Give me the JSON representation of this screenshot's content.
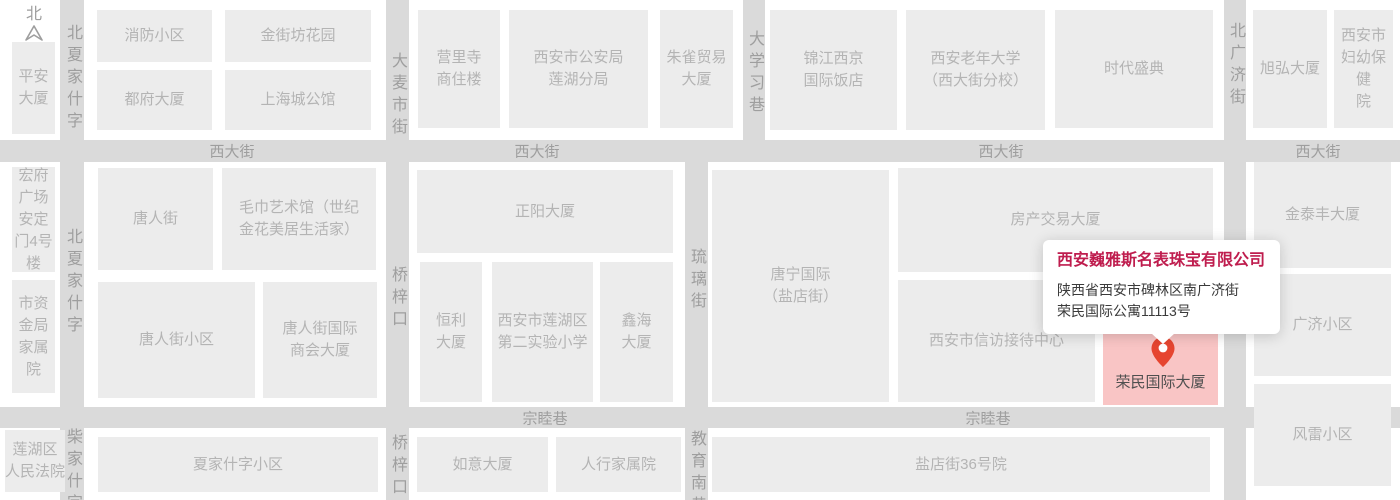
{
  "map": {
    "colors": {
      "street": "#dadada",
      "block": "#ececec",
      "block_text": "#b4b4b4",
      "street_text": "#9e9e9e",
      "highlight_bg": "#f9c5c5",
      "highlight_text": "#4f4f4f",
      "popup_title": "#bf1d4e",
      "popup_text": "#3a3a3a",
      "pin": "#e64530"
    },
    "compass": {
      "label": "北",
      "x": 22,
      "y": 6
    },
    "streets": [
      {
        "o": "h",
        "x": 0,
        "y": 140,
        "w": 1400,
        "h": 22
      },
      {
        "o": "h",
        "x": 0,
        "y": 407,
        "w": 1400,
        "h": 21
      },
      {
        "o": "v",
        "x": 60,
        "y": 0,
        "w": 24,
        "h": 500
      },
      {
        "o": "v",
        "x": 386,
        "y": 0,
        "w": 23,
        "h": 500
      },
      {
        "o": "v",
        "x": 743,
        "y": 0,
        "w": 22,
        "h": 162
      },
      {
        "o": "v",
        "x": 685,
        "y": 140,
        "w": 23,
        "h": 360
      },
      {
        "o": "v",
        "x": 1224,
        "y": 0,
        "w": 22,
        "h": 500
      }
    ],
    "street_labels": [
      {
        "text": "西大街",
        "x": 232,
        "y": 151,
        "v": false
      },
      {
        "text": "西大街",
        "x": 537,
        "y": 151,
        "v": false
      },
      {
        "text": "西大街",
        "x": 1001,
        "y": 151,
        "v": false
      },
      {
        "text": "西大街",
        "x": 1318,
        "y": 151,
        "v": false
      },
      {
        "text": "宗睦巷",
        "x": 545,
        "y": 418,
        "v": false
      },
      {
        "text": "宗睦巷",
        "x": 988,
        "y": 418,
        "v": false
      },
      {
        "text": "北夏家什字",
        "x": 72,
        "y": 24,
        "v": true
      },
      {
        "text": "北夏家什字",
        "x": 72,
        "y": 228,
        "v": true
      },
      {
        "text": "柴家什字",
        "x": 72,
        "y": 428,
        "v": true
      },
      {
        "text": "大麦市街",
        "x": 397,
        "y": 52,
        "v": true
      },
      {
        "text": "桥梓口",
        "x": 397,
        "y": 266,
        "v": true
      },
      {
        "text": "桥梓口",
        "x": 397,
        "y": 434,
        "v": true
      },
      {
        "text": "大学习巷",
        "x": 754,
        "y": 30,
        "v": true
      },
      {
        "text": "琉璃街",
        "x": 696,
        "y": 248,
        "v": true
      },
      {
        "text": "教育南巷",
        "x": 696,
        "y": 430,
        "v": true
      },
      {
        "text": "北广济街",
        "x": 1235,
        "y": 22,
        "v": true
      },
      {
        "text": "北广济街",
        "x": 1235,
        "y": 252,
        "v": true
      }
    ],
    "blocks": [
      {
        "lines": [
          "平安",
          "大厦"
        ],
        "x": 12,
        "y": 42,
        "w": 43,
        "h": 92
      },
      {
        "lines": [
          "消防小区"
        ],
        "x": 97,
        "y": 10,
        "w": 115,
        "h": 52
      },
      {
        "lines": [
          "金街坊花园"
        ],
        "x": 225,
        "y": 10,
        "w": 146,
        "h": 52
      },
      {
        "lines": [
          "都府大厦"
        ],
        "x": 97,
        "y": 70,
        "w": 115,
        "h": 60
      },
      {
        "lines": [
          "上海城公馆"
        ],
        "x": 225,
        "y": 70,
        "w": 146,
        "h": 60
      },
      {
        "lines": [
          "营里寺",
          "商住楼"
        ],
        "x": 418,
        "y": 10,
        "w": 82,
        "h": 118
      },
      {
        "lines": [
          "西安市公安局",
          "莲湖分局"
        ],
        "x": 509,
        "y": 10,
        "w": 139,
        "h": 118
      },
      {
        "lines": [
          "朱雀贸易",
          "大厦"
        ],
        "x": 660,
        "y": 10,
        "w": 73,
        "h": 118
      },
      {
        "lines": [
          "锦江西京",
          "国际饭店"
        ],
        "x": 770,
        "y": 10,
        "w": 127,
        "h": 120
      },
      {
        "lines": [
          "西安老年大学",
          "（西大街分校）"
        ],
        "x": 906,
        "y": 10,
        "w": 139,
        "h": 120
      },
      {
        "lines": [
          "时代盛典"
        ],
        "x": 1055,
        "y": 10,
        "w": 158,
        "h": 118
      },
      {
        "lines": [
          "旭弘大厦"
        ],
        "x": 1253,
        "y": 10,
        "w": 74,
        "h": 118
      },
      {
        "lines": [
          "西安市",
          "妇幼保健",
          "院"
        ],
        "x": 1334,
        "y": 10,
        "w": 59,
        "h": 118
      },
      {
        "lines": [
          "宏府",
          "广场",
          "安定",
          "门4号",
          "楼"
        ],
        "x": 12,
        "y": 167,
        "w": 43,
        "h": 105
      },
      {
        "lines": [
          "市资",
          "金局",
          "家属",
          "院"
        ],
        "x": 12,
        "y": 280,
        "w": 43,
        "h": 113
      },
      {
        "lines": [
          "唐人街"
        ],
        "x": 98,
        "y": 168,
        "w": 115,
        "h": 102
      },
      {
        "lines": [
          "毛巾艺术馆（世纪",
          "金花美居生活家）"
        ],
        "x": 222,
        "y": 168,
        "w": 154,
        "h": 102
      },
      {
        "lines": [
          "唐人街小区"
        ],
        "x": 98,
        "y": 282,
        "w": 157,
        "h": 116
      },
      {
        "lines": [
          "唐人街国际",
          "商会大厦"
        ],
        "x": 263,
        "y": 282,
        "w": 114,
        "h": 116
      },
      {
        "lines": [
          "正阳大厦"
        ],
        "x": 417,
        "y": 170,
        "w": 256,
        "h": 83
      },
      {
        "lines": [
          "恒利",
          "大厦"
        ],
        "x": 420,
        "y": 262,
        "w": 62,
        "h": 140
      },
      {
        "lines": [
          "西安市莲湖区",
          "第二实验小学"
        ],
        "x": 492,
        "y": 262,
        "w": 101,
        "h": 140
      },
      {
        "lines": [
          "鑫海",
          "大厦"
        ],
        "x": 600,
        "y": 262,
        "w": 73,
        "h": 140
      },
      {
        "lines": [
          "唐宁国际",
          "（盐店街）"
        ],
        "x": 712,
        "y": 170,
        "w": 177,
        "h": 232
      },
      {
        "lines": [
          "房产交易大厦"
        ],
        "x": 898,
        "y": 168,
        "w": 315,
        "h": 104
      },
      {
        "lines": [
          "西安市信访接待中心"
        ],
        "x": 898,
        "y": 280,
        "w": 197,
        "h": 122
      },
      {
        "lines": [
          "金泰丰大厦"
        ],
        "x": 1254,
        "y": 162,
        "w": 137,
        "h": 106
      },
      {
        "lines": [
          "广济小区"
        ],
        "x": 1254,
        "y": 274,
        "w": 137,
        "h": 102
      },
      {
        "lines": [
          "风雷小区"
        ],
        "x": 1254,
        "y": 384,
        "w": 137,
        "h": 102
      },
      {
        "lines": [
          "莲湖区",
          "人民法院"
        ],
        "x": 5,
        "y": 430,
        "w": 60,
        "h": 62
      },
      {
        "lines": [
          "夏家什字小区"
        ],
        "x": 98,
        "y": 437,
        "w": 280,
        "h": 55
      },
      {
        "lines": [
          "如意大厦"
        ],
        "x": 417,
        "y": 437,
        "w": 131,
        "h": 55
      },
      {
        "lines": [
          "人行家属院"
        ],
        "x": 556,
        "y": 437,
        "w": 125,
        "h": 55
      },
      {
        "lines": [
          "盐店街36号院"
        ],
        "x": 712,
        "y": 437,
        "w": 498,
        "h": 55
      },
      {
        "lines": [
          "荣民国际大厦"
        ],
        "x": 1103,
        "y": 330,
        "w": 115,
        "h": 75,
        "highlight": true
      }
    ],
    "pin": {
      "x": 1163,
      "y": 337
    },
    "popup": {
      "x": 1043,
      "y": 240,
      "w": 237,
      "h": 92,
      "title": "西安巍雅斯名表珠宝有限公司",
      "address_line1": "陕西省西安市碑林区南广济街",
      "address_line2": "荣民国际公寓11113号"
    }
  }
}
